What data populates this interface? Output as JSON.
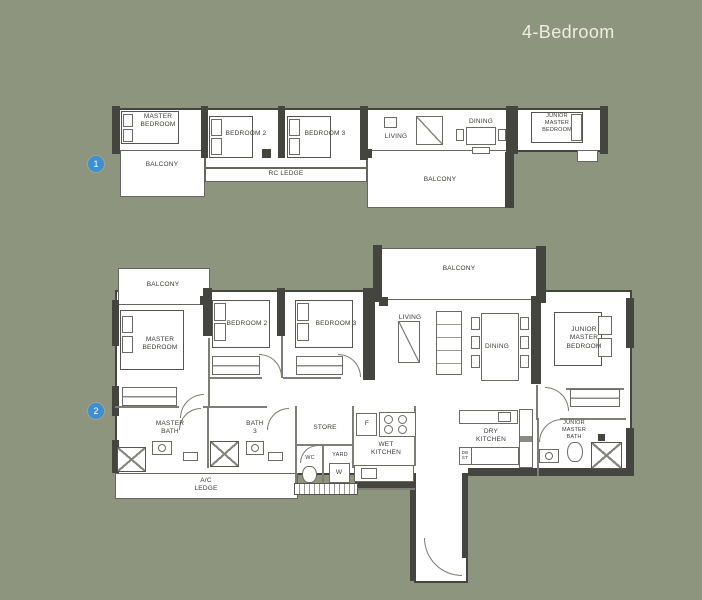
{
  "title": "4-Bedroom",
  "badges": {
    "one": "1",
    "two": "2"
  },
  "colors": {
    "background": "#8e957e",
    "wall": "#45453f",
    "floor": "#ffffff",
    "badge_blue": "#3d8ed2",
    "title_text": "#efede3",
    "label_text": "#3a3a36"
  },
  "plan1": {
    "labels": {
      "master_bedroom": "MASTER\nBEDROOM",
      "bedroom2": "BEDROOM 2",
      "bedroom3": "BEDROOM 3",
      "living": "LIVING",
      "dining": "DINING",
      "junior_master_bedroom": "JUNIOR\nMASTER\nBEDROOM",
      "balcony_left": "BALCONY",
      "rc_ledge": "RC LEDGE",
      "balcony_main": "BALCONY"
    }
  },
  "plan2": {
    "labels": {
      "balcony_top": "BALCONY",
      "balcony_left": "BALCONY",
      "master_bedroom": "MASTER\nBEDROOM",
      "bedroom2": "BEDROOM 2",
      "bedroom3": "BEDROOM 3",
      "living": "LIVING",
      "dining": "DINING",
      "junior_master_bedroom": "JUNIOR\nMASTER\nBEDROOM",
      "master_bath": "MASTER\nBATH",
      "bath_3": "BATH\n3",
      "store": "STORE",
      "fridge": "F",
      "wet_kitchen": "WET\nKITCHEN",
      "wc": "WC",
      "yard": "YARD",
      "washer": "W",
      "dry_kitchen": "DRY\nKITCHEN",
      "db_st": "DB\nST",
      "junior_master_bath": "JUNIOR\nMASTER\nBATH",
      "ac_ledge": "A/C\nLEDGE"
    }
  }
}
